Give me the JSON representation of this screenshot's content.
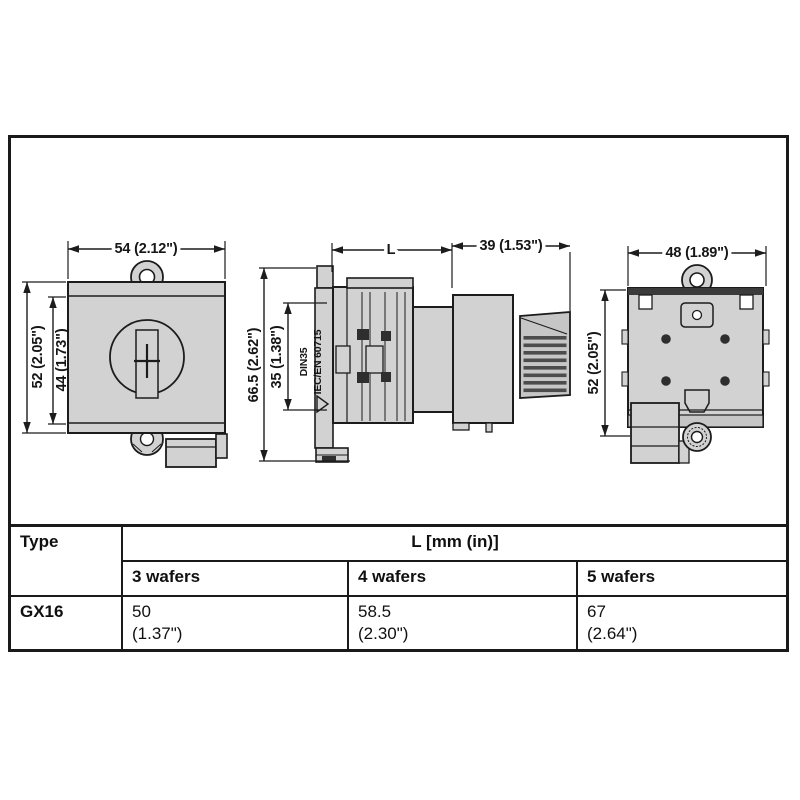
{
  "views": {
    "front": {
      "width": "54 (2.12\")",
      "height_outer": "52 (2.05\")",
      "height_inner": "44 (1.73\")"
    },
    "side": {
      "length": "L",
      "knob_depth": "39 (1.53\")",
      "height_outer": "66.5 (2.62\")",
      "rail_width": "35 (1.38\")",
      "rail_standard": "DIN35",
      "rail_norm": "IEC/EN 60715"
    },
    "rear": {
      "width": "48 (1.89\")",
      "height": "52 (2.05\")"
    }
  },
  "table": {
    "type_header": "Type",
    "length_header": "L [mm (in)]",
    "columns": [
      "3 wafers",
      "4 wafers",
      "5 wafers"
    ],
    "rows": [
      {
        "type": "GX16",
        "values": [
          {
            "mm": "50",
            "in": "(1.37\")"
          },
          {
            "mm": "58.5",
            "in": "(2.30\")"
          },
          {
            "mm": "67",
            "in": "(2.64\")"
          }
        ]
      }
    ]
  },
  "colors": {
    "line": "#1c1c1c",
    "fill_light": "#d2d2d2",
    "fill_dark": "#2e2e2e"
  }
}
